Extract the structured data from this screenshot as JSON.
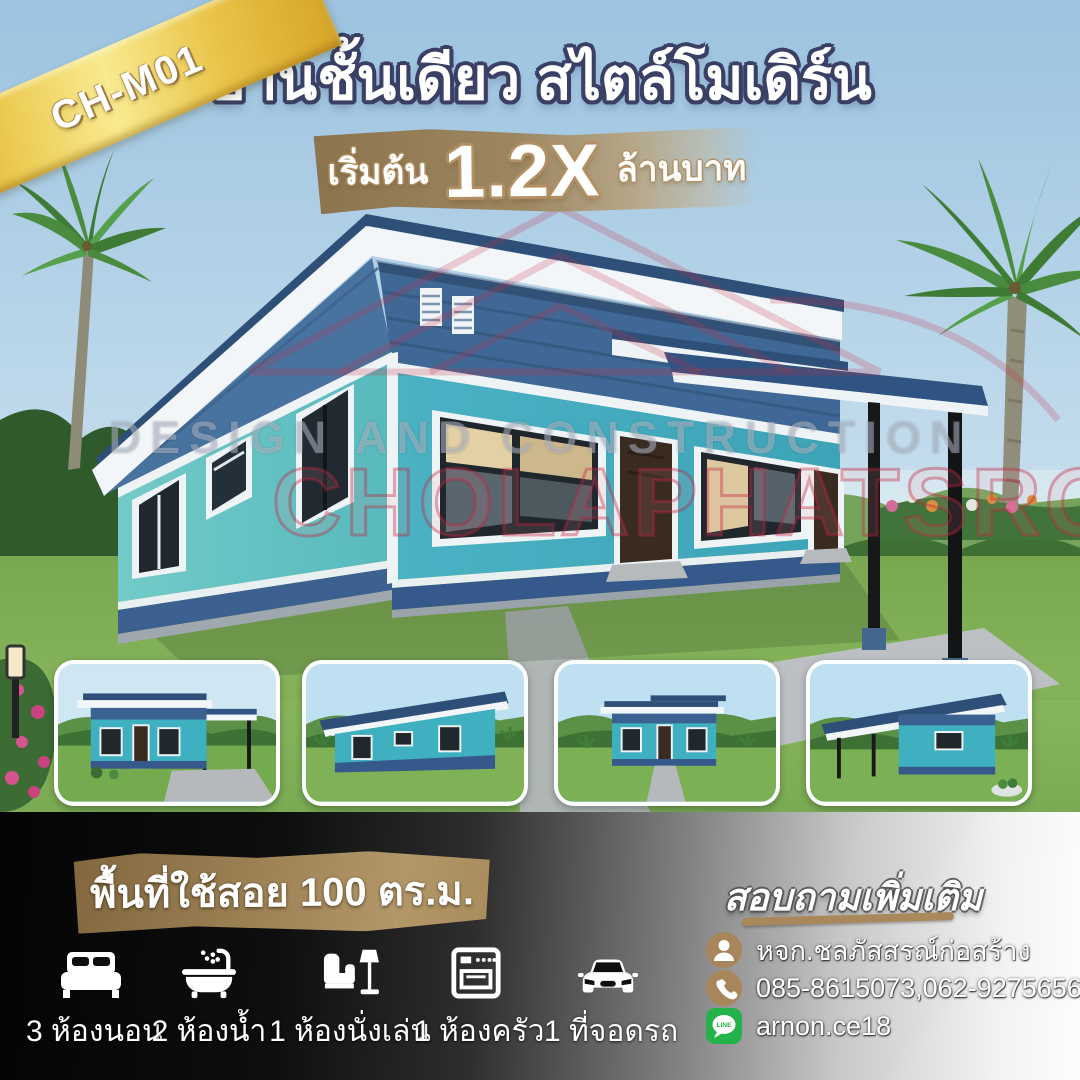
{
  "ribbon": {
    "code": "CH-M01"
  },
  "header": {
    "title": "บ้านชั้นเดียว สไตล์โมเดิร์น"
  },
  "price": {
    "prefix": "เริ่มต้น",
    "value": "1.2X",
    "suffix": "ล้านบาท"
  },
  "watermark": {
    "line1": "DESIGN AND CONSTRUCTION",
    "line2": "CHOLAPHATSRON"
  },
  "area_banner": {
    "text": "พื้นที่ใช้สอย 100 ตร.ม."
  },
  "features": [
    {
      "icon": "bed-icon",
      "label": "3 ห้องนอน"
    },
    {
      "icon": "bathtub-icon",
      "label": "2 ห้องน้ำ"
    },
    {
      "icon": "sofa-lamp-icon",
      "label": "1 ห้องนั่งเล่น"
    },
    {
      "icon": "stove-icon",
      "label": "1 ห้องครัว"
    },
    {
      "icon": "car-icon",
      "label": "1 ที่จอดรถ"
    }
  ],
  "contact": {
    "heading": "สอบถามเพิ่มเติม",
    "items": [
      {
        "icon": "person-icon",
        "text": "หจก.ชลภัสสรณ์ก่อสร้าง"
      },
      {
        "icon": "phone-icon",
        "text": "085-8615073,062-9275656"
      },
      {
        "icon": "line-icon",
        "text": "arnon.ce18"
      }
    ]
  },
  "colors": {
    "ribbon_gold": "#ecc94f",
    "tan_accent": "#a8885b",
    "title_outline_navy": "#3a4065",
    "wall_teal": "#4fb5c2",
    "roof_blue": "#35608f",
    "line_green": "#24b24b",
    "section_dark": "#050505",
    "section_light": "#fafafa"
  }
}
